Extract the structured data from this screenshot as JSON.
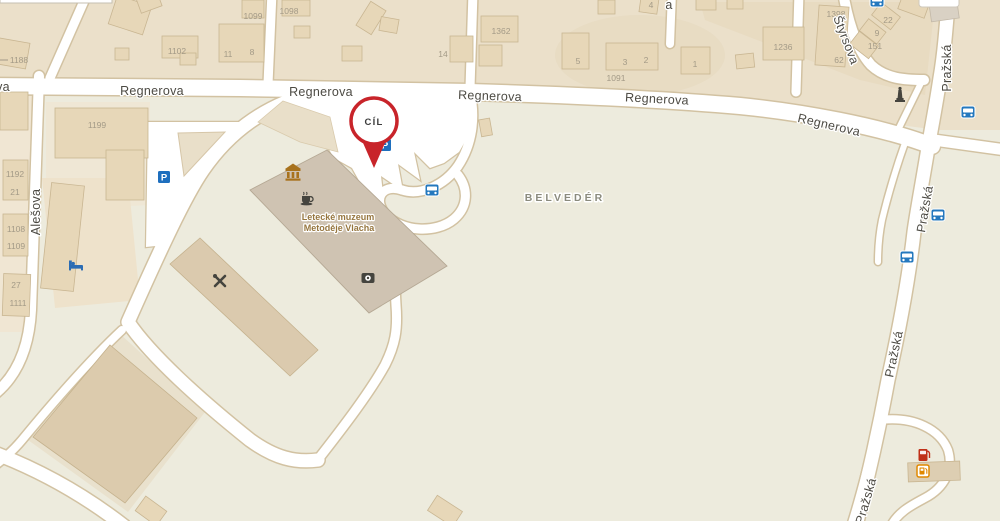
{
  "map": {
    "destination_marker": {
      "label": "CÍL"
    },
    "area_labels": {
      "belvedere": "BELVEDÉR"
    },
    "poi_labels": {
      "museum_line1": "Letecké muzeum",
      "museum_line2": "Metoděje Vlacha"
    },
    "street_names": {
      "regnerova": "Regnerova",
      "alesova": "Alešova",
      "prazska": "Pražská",
      "styrsova": "Štyrsova",
      "partial_left": "va",
      "partial_top_stub": "a"
    },
    "house_numbers": {
      "hn1188": "1188",
      "hn1102": "1102",
      "hn11": "11",
      "hn8": "8",
      "hn1099": "1099",
      "hn1098": "1098",
      "hn14": "14",
      "hn1362": "1362",
      "hn5": "5",
      "hn3": "3",
      "hn2": "2",
      "hn1091": "1091",
      "hn1": "1",
      "hn4": "4",
      "hn1236": "1236",
      "hn1398": "1398",
      "hn22": "22",
      "hn9": "9",
      "hn151": "151",
      "hn62": "62",
      "hn1199": "1199",
      "hn1192": "1192",
      "hn21": "21",
      "hn1108": "1108",
      "hn1109": "1109",
      "hn27": "27",
      "hn1111": "1111"
    },
    "icons": {
      "parking_letter": "P",
      "glyphs": {
        "parking": "blue square with P",
        "bus_stop": "blue rounded square with bus front",
        "hotel": "blue bed",
        "museum": "brown classical temple",
        "cafe": "dark coffee cup",
        "workshop": "crossed tools",
        "camera": "dark square with lens",
        "monument": "dark obelisk",
        "fuel_station": "red pump and orange pump sign"
      }
    },
    "colors": {
      "land_base": "#edebdd",
      "block_tan": "#ebe0ca",
      "road_fill": "#ffffff",
      "road_casing": "#d2c2a2",
      "building_fill": "#e7d7b8",
      "museum_building": "#cfc3b2",
      "marker_red": "#c8242a",
      "parking_blue": "#1e6fbe",
      "bus_blue": "#2478be",
      "hotel_blue": "#2b6cb4",
      "temple_brown": "#a8721d",
      "poi_dark": "#45443e",
      "fuel_red": "#c03018",
      "fuel_orange": "#e08800"
    }
  }
}
